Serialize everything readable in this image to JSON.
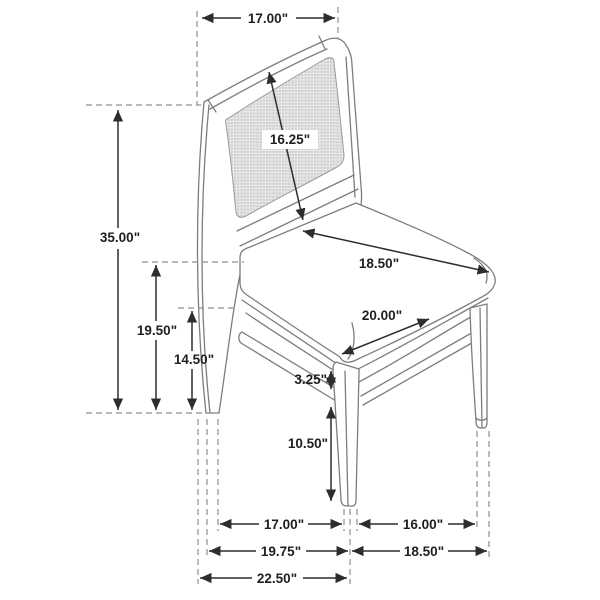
{
  "diagram": {
    "subject": "Dining side chair with cane back - dimension line drawing, three-quarter view",
    "unit": "inches",
    "line_color": "#7d7d7d",
    "dim_color": "#2d2d2d",
    "dims": {
      "back_width": "17.00\"",
      "overall_height": "35.00\"",
      "back_panel": "16.25\"",
      "seat_depth": "18.50\"",
      "seat_width": "20.00\"",
      "seat_back_height": "19.50\"",
      "stretcher_height": "14.50\"",
      "apron_stretcher_gap": "3.25\"",
      "leg_below_stretcher": "10.50\"",
      "front_leg_span": "17.00\"",
      "side_leg_span": "16.00\"",
      "front_span_outer": "19.75\"",
      "side_span_outer": "18.50\"",
      "overall_depth": "22.50\""
    }
  }
}
